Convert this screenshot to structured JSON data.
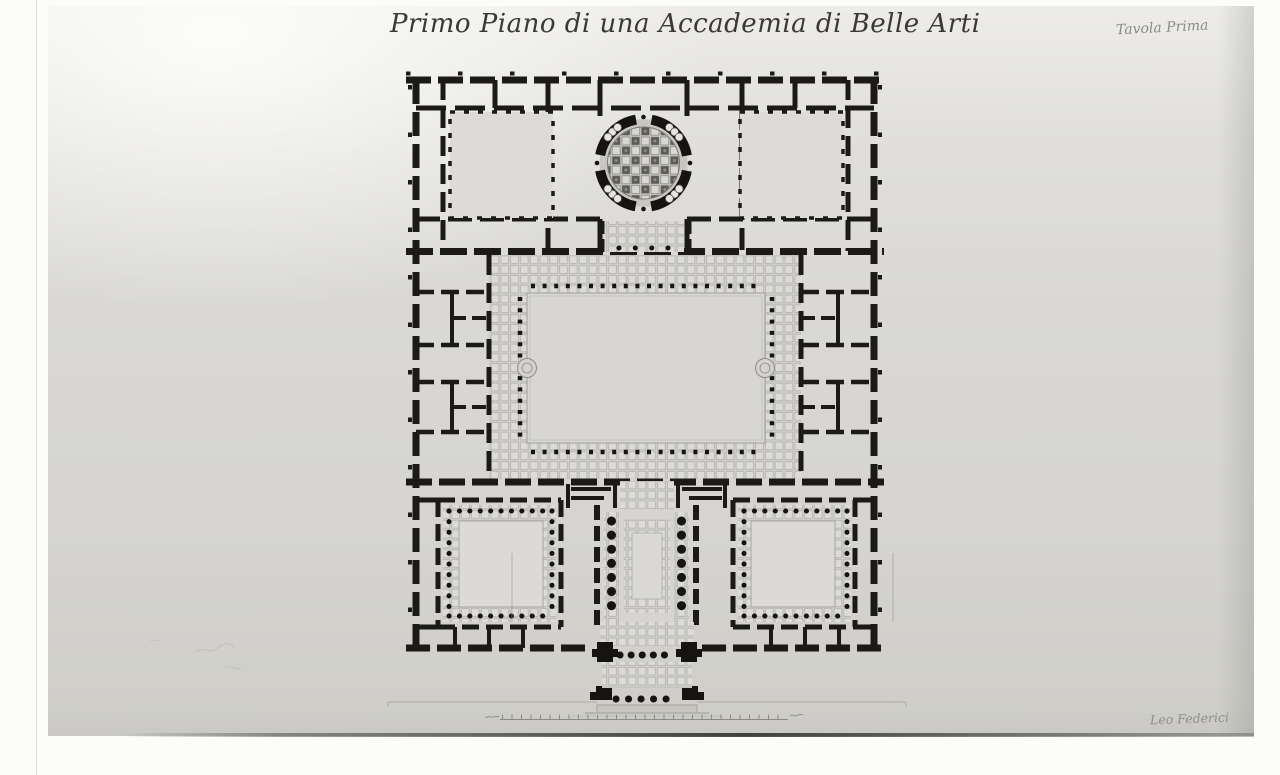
{
  "photograph": {
    "description": "black-and-white photograph of an ink architectural drawing on paper",
    "title": "Primo Piano di una Accademia di Belle Arti",
    "plate_label": "Tavola Prima",
    "signature": "Leo Federici"
  },
  "floor_plan": {
    "subject": "first-floor plan of an Academy of Fine Arts",
    "features": [
      "circular domed vestibule with coffered rotunda ceiling",
      "two square rooms flanking the rotunda",
      "large rectangular courtyard surrounded by coffered portico and colonnade",
      "side wings subdivided into small rooms",
      "two square halls ringed by columns",
      "central columned hall with coffered ceiling",
      "twin staircases flanking a coffered vestibule",
      "projecting entrance portico with column rows and steps",
      "graphic scale bar with tick marks"
    ]
  },
  "colors": {
    "margin_white": "#fcfcfb",
    "paper_light": "#edece9",
    "paper_mid": "#d7d6d2",
    "paper_dark": "#c9c8c4",
    "ink_black": "#1b1a16",
    "coffer_light": "#dcdbd7",
    "coffer_shadow": "#b2b1ac",
    "coffer_dark": "#5c5b55",
    "faint_line": "#8a8984"
  }
}
